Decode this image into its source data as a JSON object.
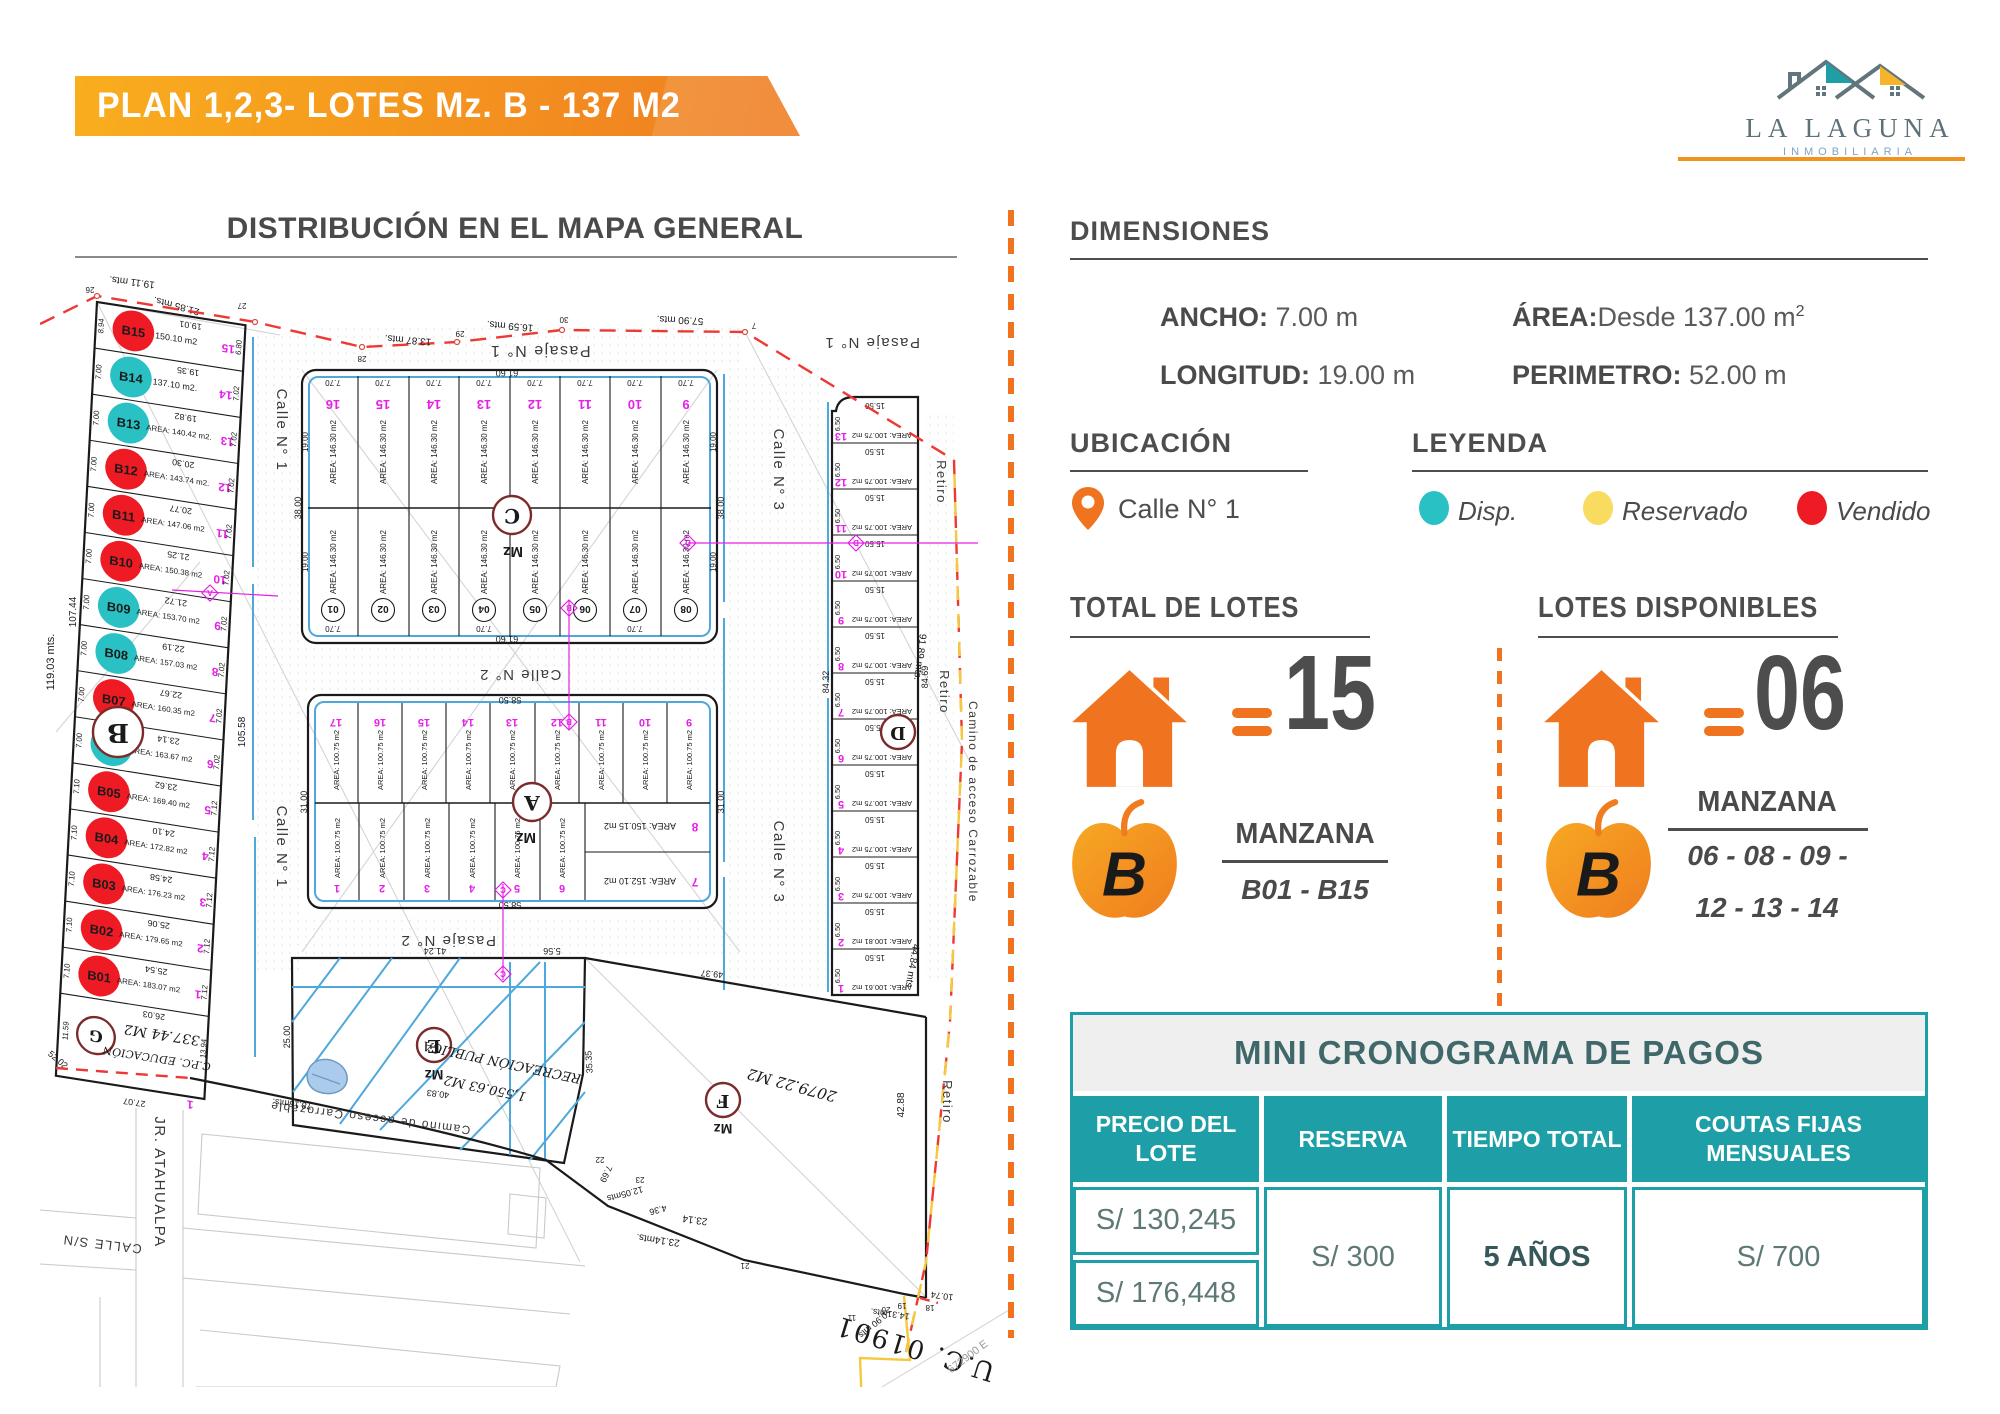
{
  "banner": {
    "title": "PLAN 1,2,3- LOTES Mz. B - 137 M2"
  },
  "logo": {
    "name": "LA LAGUNA",
    "subtitle": "INMOBILIARIA"
  },
  "map_section": {
    "title": "DISTRIBUCIÓN EN EL MAPA GENERAL"
  },
  "colors": {
    "accent": "#F0731F",
    "teal": "#1E9EA6",
    "vendido": "#EE1B24",
    "disponible": "#29C1C4",
    "reservado": "#F9DC5F",
    "magenta": "#E520E5"
  },
  "dimensions": {
    "heading": "DIMENSIONES",
    "ancho_label": "ANCHO:",
    "ancho_value": "7.00 m",
    "area_label": "ÁREA:",
    "area_value": "Desde  137.00 m",
    "area_sup": "2",
    "longitud_label": "LONGITUD:",
    "longitud_value": "19.00 m",
    "perimetro_label": "PERIMETRO:",
    "perimetro_value": "52.00 m"
  },
  "ubicacion": {
    "heading": "UBICACIÓN",
    "value": "Calle N° 1"
  },
  "leyenda": {
    "heading": "LEYENDA",
    "items": [
      {
        "label": "Disp.",
        "color": "#29C1C4"
      },
      {
        "label": "Reservado",
        "color": "#F9DC5F"
      },
      {
        "label": "Vendido",
        "color": "#EE1B24"
      }
    ]
  },
  "totales": {
    "total_heading": "TOTAL DE LOTES",
    "equals": "=",
    "total_value": "15",
    "disponibles_heading": "LOTES DISPONIBLES",
    "disponibles_value": "06"
  },
  "manzana_left": {
    "letter": "B",
    "label": "MANZANA",
    "range": "B01 - B15"
  },
  "manzana_right": {
    "letter": "B",
    "label": "MANZANA",
    "line1": "06 - 08  - 09 -",
    "line2": "12 - 13 - 14"
  },
  "cronograma": {
    "title": "MINI CRONOGRAMA DE PAGOS",
    "col1": "PRECIO DEL LOTE",
    "col2": "RESERVA",
    "col3": "TIEMPO TOTAL",
    "col4": "COUTAS FIJAS MENSUALES",
    "precio1": "S/ 130,245",
    "precio2": "S/ 176,448",
    "reserva": "S/ 300",
    "tiempo": "5 AÑOS",
    "cuotas": "S/ 700"
  },
  "map": {
    "mzB": {
      "letter": "B",
      "mz": "Mz",
      "edge_top": "21.85 mts.",
      "left_total": "119.03 mts.",
      "left_part": "107.44",
      "right_part": "105.58",
      "corner": "52.02",
      "lots": [
        {
          "id": "B15",
          "num": "15",
          "area": "150.10 m2",
          "top": "19.01",
          "left": "8.94",
          "right": "6.80",
          "color": "#EE1B24"
        },
        {
          "id": "B14",
          "num": "14",
          "area": "137.10 m2.",
          "top": "19.35",
          "left": "7.00",
          "right": "7.02",
          "color": "#29C1C4"
        },
        {
          "id": "B13",
          "num": "13",
          "area": "AREA: 140.42 m2.",
          "top": "19.82",
          "left": "7.00",
          "right": "7.02",
          "color": "#29C1C4"
        },
        {
          "id": "B12",
          "num": "12",
          "area": "AREA: 143.74 m2.",
          "top": "20.30",
          "left": "7.00",
          "right": "7.02",
          "color": "#EE1B24"
        },
        {
          "id": "B11",
          "num": "11",
          "area": "AREA: 147.06 m2",
          "top": "20.77",
          "left": "7.00",
          "right": "7.02",
          "color": "#EE1B24"
        },
        {
          "id": "B10",
          "num": "10",
          "area": "AREA: 150.38 m2",
          "top": "21.25",
          "left": "7.00",
          "right": "7.02",
          "color": "#EE1B24"
        },
        {
          "id": "B09",
          "num": "9",
          "area": "AREA: 153.70 m2",
          "top": "21.72",
          "left": "7.00",
          "right": "7.02",
          "color": "#29C1C4"
        },
        {
          "id": "B08",
          "num": "8",
          "area": "AREA: 157.03 m2",
          "top": "22.19",
          "left": "7.00",
          "right": "7.02",
          "color": "#29C1C4"
        },
        {
          "id": "B07",
          "num": "7",
          "area": "AREA: 160.35 m2",
          "top": "22.67",
          "left": "7.00",
          "right": "7.02",
          "color": "#EE1B24"
        },
        {
          "id": "B06",
          "num": "6",
          "area": "AREA: 163.67 m2",
          "top": "23.14",
          "left": "7.00",
          "right": "7.02",
          "color": "#29C1C4"
        },
        {
          "id": "B05",
          "num": "5",
          "area": "AREA: 169.40 m2",
          "top": "23.62",
          "left": "7.10",
          "right": "7.12",
          "color": "#EE1B24"
        },
        {
          "id": "B04",
          "num": "4",
          "area": "AREA: 172.82 m2",
          "top": "24.10",
          "left": "7.10",
          "right": "7.12",
          "color": "#EE1B24"
        },
        {
          "id": "B03",
          "num": "3",
          "area": "AREA: 176.23 m2",
          "top": "24.58",
          "left": "7.10",
          "right": "7.12",
          "color": "#EE1B24"
        },
        {
          "id": "B02",
          "num": "2",
          "area": "AREA: 179.65 m2",
          "top": "25.06",
          "left": "7.10",
          "right": "7.12",
          "color": "#EE1B24"
        },
        {
          "id": "B01",
          "num": "1",
          "area": "AREA: 183.07 m2",
          "top": "25.54",
          "left": "7.10",
          "right": "7.12",
          "color": "#EE1B24"
        }
      ],
      "g": {
        "letter": "G",
        "area": "337.44 M2",
        "name": "C.P.C. EDUCACIÓN",
        "top": "26.03",
        "left": "11.59",
        "right": "13.94",
        "bottom": "27.07",
        "num": "1"
      }
    },
    "mzC": {
      "letter": "C",
      "mz": "Mz",
      "area_label": "AREA: 146.30 m2",
      "width_label": "7.70",
      "depth_label": "19.00",
      "len_top": "61.60",
      "len_bottom": "61.60",
      "len_side": "38.00",
      "top_nums": [
        "16",
        "15",
        "14",
        "13",
        "12",
        "11",
        "10",
        "9"
      ],
      "bottom_nums": [
        "01",
        "02",
        "03",
        "04",
        "05",
        "06",
        "07",
        "08"
      ]
    },
    "mzA": {
      "letter": "A",
      "mz": "Mz",
      "area_label": "AREA: 100.75 m2",
      "len_top": "58.50",
      "len_bottom": "58.50",
      "len_side": "31.00",
      "top_nums": [
        "17",
        "16",
        "15",
        "14",
        "13",
        "12",
        "11",
        "10",
        "9"
      ],
      "bottom_nums": [
        "1",
        "2",
        "3",
        "4",
        "5",
        "6"
      ],
      "lot8_num": "8",
      "lot8_area": "AREA: 150.15 m2",
      "lot7_num": "7",
      "lot7_area": "AREA: 152.10 m2"
    },
    "mzD": {
      "letter": "D",
      "width_label": "15.50",
      "side_label": "6.50",
      "len_left": "84.32",
      "len_right": "84.69",
      "rows": [
        {
          "num": "13",
          "area": "AREA: 100.75 m2"
        },
        {
          "num": "12",
          "area": "AREA: 100.75 m2"
        },
        {
          "num": "11",
          "area": "AREA: 100.75 m2"
        },
        {
          "num": "10",
          "area": "AREA: 100.75 m2"
        },
        {
          "num": "9",
          "area": "AREA: 100.75 m2"
        },
        {
          "num": "8",
          "area": "AREA: 100.75 m2"
        },
        {
          "num": "7",
          "area": "AREA: 100.75 m2"
        },
        {
          "num": "6",
          "area": "AREA: 100.75 m2"
        },
        {
          "num": "5",
          "area": "AREA: 100.75 m2"
        },
        {
          "num": "4",
          "area": "AREA: 100.75 m2"
        },
        {
          "num": "3",
          "area": "AREA: 100.75 m2"
        },
        {
          "num": "2",
          "area": "AREA: 100.81 m2"
        },
        {
          "num": "1",
          "area": "AREA: 100.61 m2"
        }
      ]
    },
    "mzE": {
      "letter": "E",
      "mz": "Mz",
      "name": "RECREACIÓN PUBLICA",
      "area": "1,550.63 M2",
      "len_top": "41.24",
      "len_left": "25.00",
      "len_right": "35.35",
      "len_gap": "5.56"
    },
    "mzF": {
      "letter": "F",
      "mz": "Mz",
      "area": "2079.22 M2",
      "len_top": "49.37"
    },
    "streets": {
      "pasaje1": "Pasaje N° 1",
      "calle1": "Calle N° 1",
      "calle2": "Calle N° 2",
      "pasaje2": "Pasaje N° 2",
      "calle3": "Calle N° 3",
      "retiro": "Retiro",
      "camino": "Camino de acceso Carrozable",
      "jr_atahualpa": "JR. ATAHUALPA",
      "calle_sn": "CALLE S/N"
    },
    "measures": {
      "m19_11": "19.11 mts.",
      "m13_87": "13.87 mts.",
      "m16_59": "16.59 mts.",
      "m57_90": "57.90 mts.",
      "m91_89": "91.89 mts.",
      "m44_84": "44.84 mts.",
      "m42_88": "42.88",
      "m78_15": "78.15mts.",
      "m40_83": "40.83",
      "m23_14a": "23.14mts.",
      "m23_14b": "23.14",
      "m12_05": "12.05mts",
      "m4_36": "4.36",
      "m7_69": "7.69",
      "m14_31": "14.31mts.",
      "m10_74": "10.74",
      "m0_90": "0.90 mts."
    },
    "points": {
      "p7": "7",
      "p11": "11",
      "p18": "18",
      "p19": "19",
      "p20": "20",
      "p21": "21",
      "p22": "22",
      "p23": "23",
      "p26": "26",
      "p27": "27",
      "p28": "28",
      "p29": "29",
      "p30": "30"
    },
    "uc_label": "U.C. 01901",
    "coord_label": "672900 E",
    "markers": {
      "a": "A",
      "b": "B",
      "c": "C",
      "d": "D"
    }
  }
}
